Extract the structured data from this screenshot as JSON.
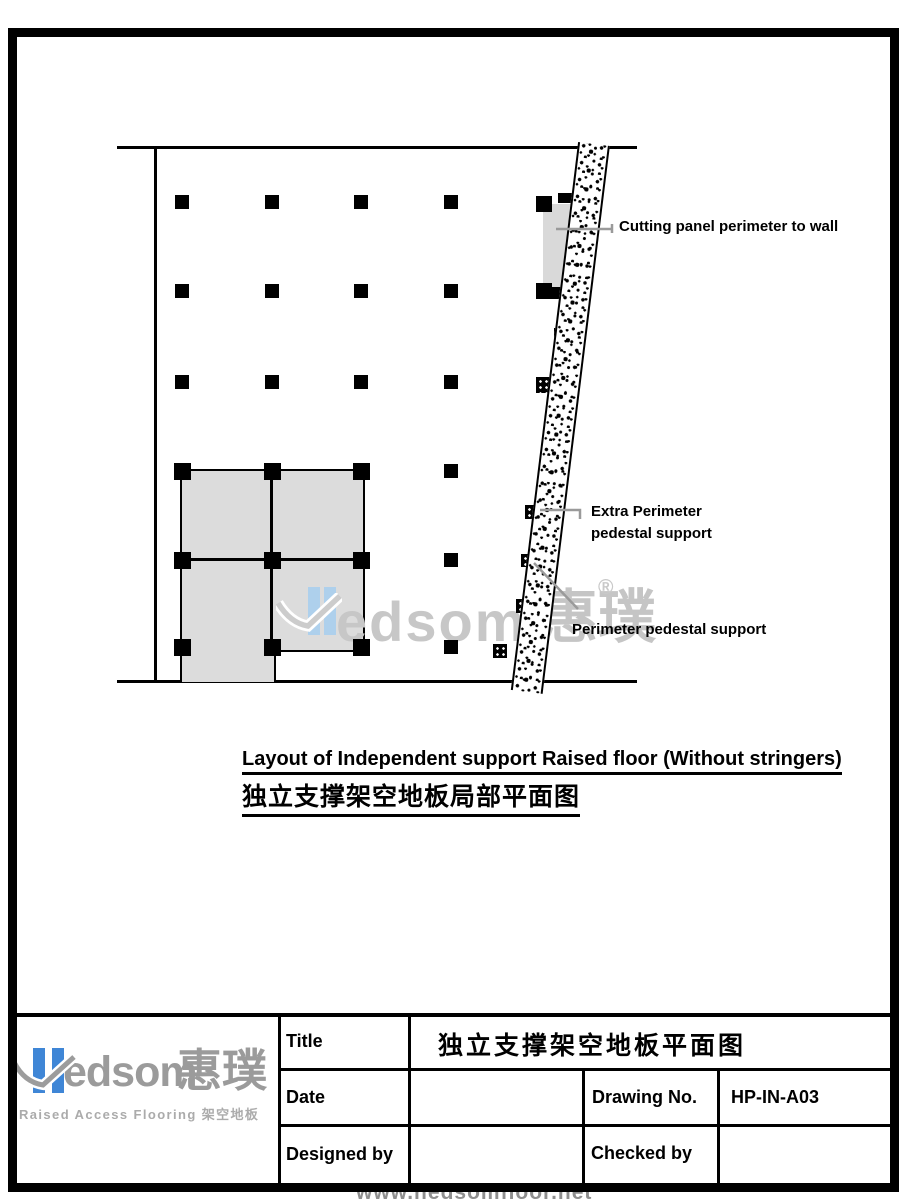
{
  "colors": {
    "accent_blue": "#3f86d6",
    "watermark_blue": "#aed0ec",
    "logo_gray": "#9b9b9b",
    "watermark_gray": "#c7c7c7",
    "leader_gray": "#9a9a9a",
    "panel_gray": "#dcdcdc"
  },
  "drawing": {
    "annotations": {
      "cutting": "Cutting panel perimeter to wall",
      "extra_line1": "Extra Perimeter",
      "extra_line2": "pedestal support",
      "perimeter": "Perimeter pedestal support"
    },
    "caption": {
      "en": "Layout of Independent support Raised floor (Without stringers)",
      "zh": "独立支撑架空地板局部平面图"
    },
    "watermark": {
      "edsom": "edsom",
      "cn": "惠璞",
      "reg": "®"
    },
    "pedestal_grid": {
      "cols": [
        182,
        272,
        361,
        451
      ],
      "rows": [
        202,
        291,
        382,
        471,
        560,
        647
      ]
    },
    "wall_pedestals": [
      {
        "x": 579,
        "y": 149,
        "w": 20,
        "h": 20
      },
      {
        "x": 554,
        "y": 328,
        "w": 15,
        "h": 15
      },
      {
        "x": 536,
        "y": 377,
        "w": 26,
        "h": 16
      },
      {
        "x": 545,
        "y": 417,
        "w": 15,
        "h": 15
      },
      {
        "x": 544,
        "y": 468,
        "w": 17,
        "h": 17
      },
      {
        "x": 525,
        "y": 505,
        "w": 14,
        "h": 14
      },
      {
        "x": 521,
        "y": 554,
        "w": 13,
        "h": 13
      },
      {
        "x": 516,
        "y": 599,
        "w": 14,
        "h": 14
      },
      {
        "x": 493,
        "y": 644,
        "w": 14,
        "h": 14
      }
    ]
  },
  "title_block": {
    "labels": {
      "title": "Title",
      "date": "Date",
      "drawing_no": "Drawing No.",
      "designed_by": "Designed by",
      "checked_by": "Checked by"
    },
    "values": {
      "title": "独立支撑架空地板平面图",
      "date": "",
      "drawing_no": "HP-IN-A03",
      "designed_by": "",
      "checked_by": ""
    },
    "logo": {
      "edsom": "edsom",
      "cn": "惠璞",
      "subtitle": "Raised Access Flooring 架空地板"
    }
  },
  "footer": {
    "watermark": "www.hedsomfloor.net"
  }
}
